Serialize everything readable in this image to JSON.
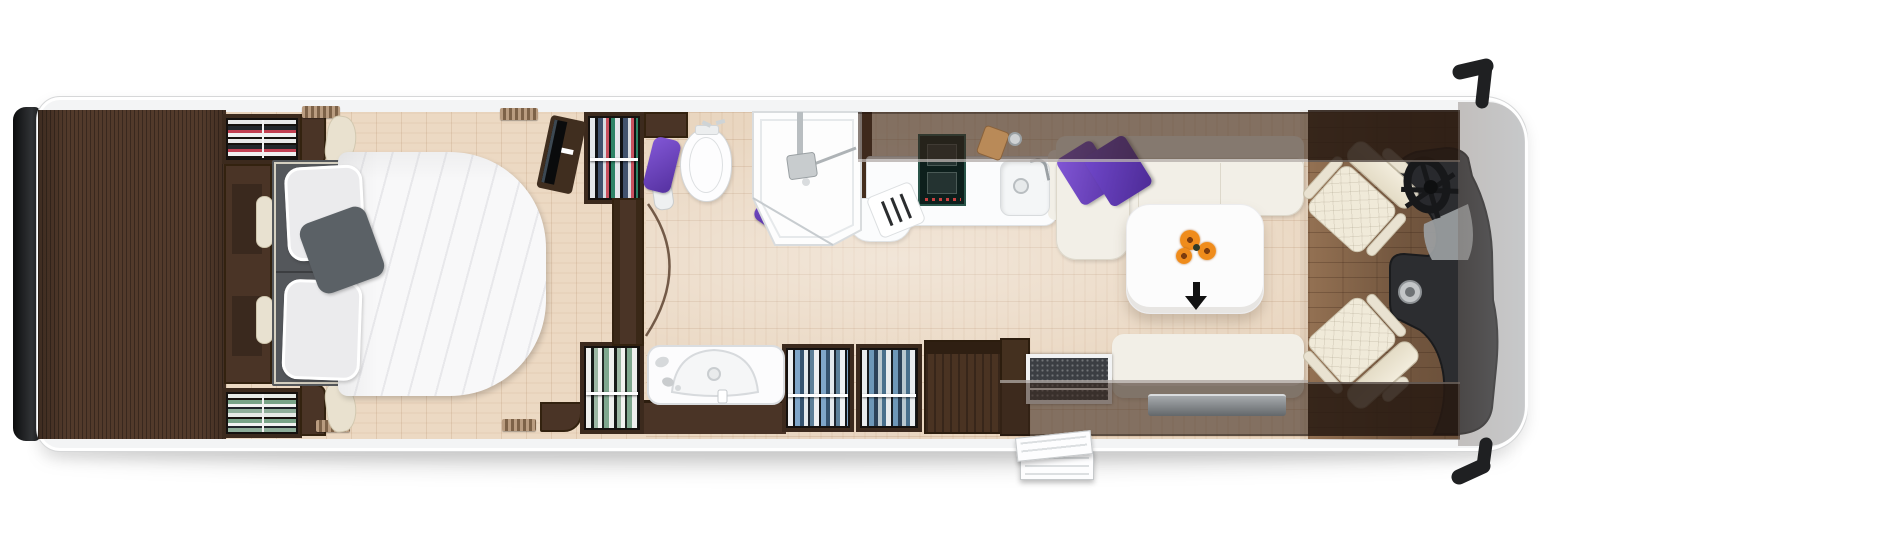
{
  "title": "Motorhome floor plan (top view)",
  "colors": {
    "body_fill": "#f3f4f5",
    "wall_line": "#d6d7d8",
    "black": "#17181a",
    "deck": "#523a2b",
    "cabinet": "#4a3426",
    "wardrobe_interior": "#15110e",
    "floor": "#e9d6c0",
    "cab_floor": "#9b7757",
    "band": "rgba(56,38,28,0.58)",
    "bed_gray": "#54575b",
    "pillow": "#ebebed",
    "pillow_accent": "#5b6166",
    "duvet": "#f8f8f9",
    "cream": "#f2efe7",
    "seat_cream": "#f0ead9",
    "purple": "#6f46c4",
    "purple_dark": "#4f2f9e",
    "orange": "#ef8c1c",
    "table": "#fcfcfc",
    "fixture_line": "#d3d6d8",
    "chrome": "#b9bec1",
    "hob": "#0d1f1c",
    "hob_frame": "#2a554a",
    "mat": "#3b3e43",
    "dash": "#2c2d30"
  },
  "items": {
    "vehicle": "Motorhome body (top view)",
    "rear_bumper": "Rear bumper",
    "rear_deck": "Rear storage deck",
    "wardrobe_folded": "Wardrobe with folded clothes",
    "wardrobe_hanging": "Wardrobe with hanging clothes",
    "headboard": "Bed headboard console",
    "bed": "Double bed",
    "duvet": "Duvet",
    "pillow": "Pillow",
    "accent_pillow": "Accent pillow",
    "tv": "TV on swivel bracket",
    "partition": "Partition wall",
    "toilet": "Toilet",
    "towel": "Towel",
    "shower": "Shower cubicle",
    "washbasin": "Washbasin vanity",
    "sideboard": "Sideboard cabinet",
    "hob": "Induction hob",
    "kitchen_sink": "Kitchen sink",
    "knife_board": "Cutting board with knives",
    "counter": "Kitchen worktop",
    "sofa": "L-shaped lounge sofa",
    "purple_cushions": "Purple scatter cushions",
    "table": "Lounge table",
    "flowers": "Flowers",
    "entry_arrow": "Entry direction arrow",
    "bench": "Side bench seat",
    "drawer": "Exterior locker drawer",
    "entry_mat": "Entry door mat",
    "entry_steps": "Entry steps",
    "overhead_lockers": "Overhead lockers",
    "driver_seat": "Driver swivel seat",
    "passenger_seat": "Passenger swivel seat",
    "steering_wheel": "Steering wheel",
    "dashboard": "Dashboard",
    "windshield": "Windscreen / cab front",
    "mirror": "Side mirror",
    "vent": "Wall vent"
  }
}
